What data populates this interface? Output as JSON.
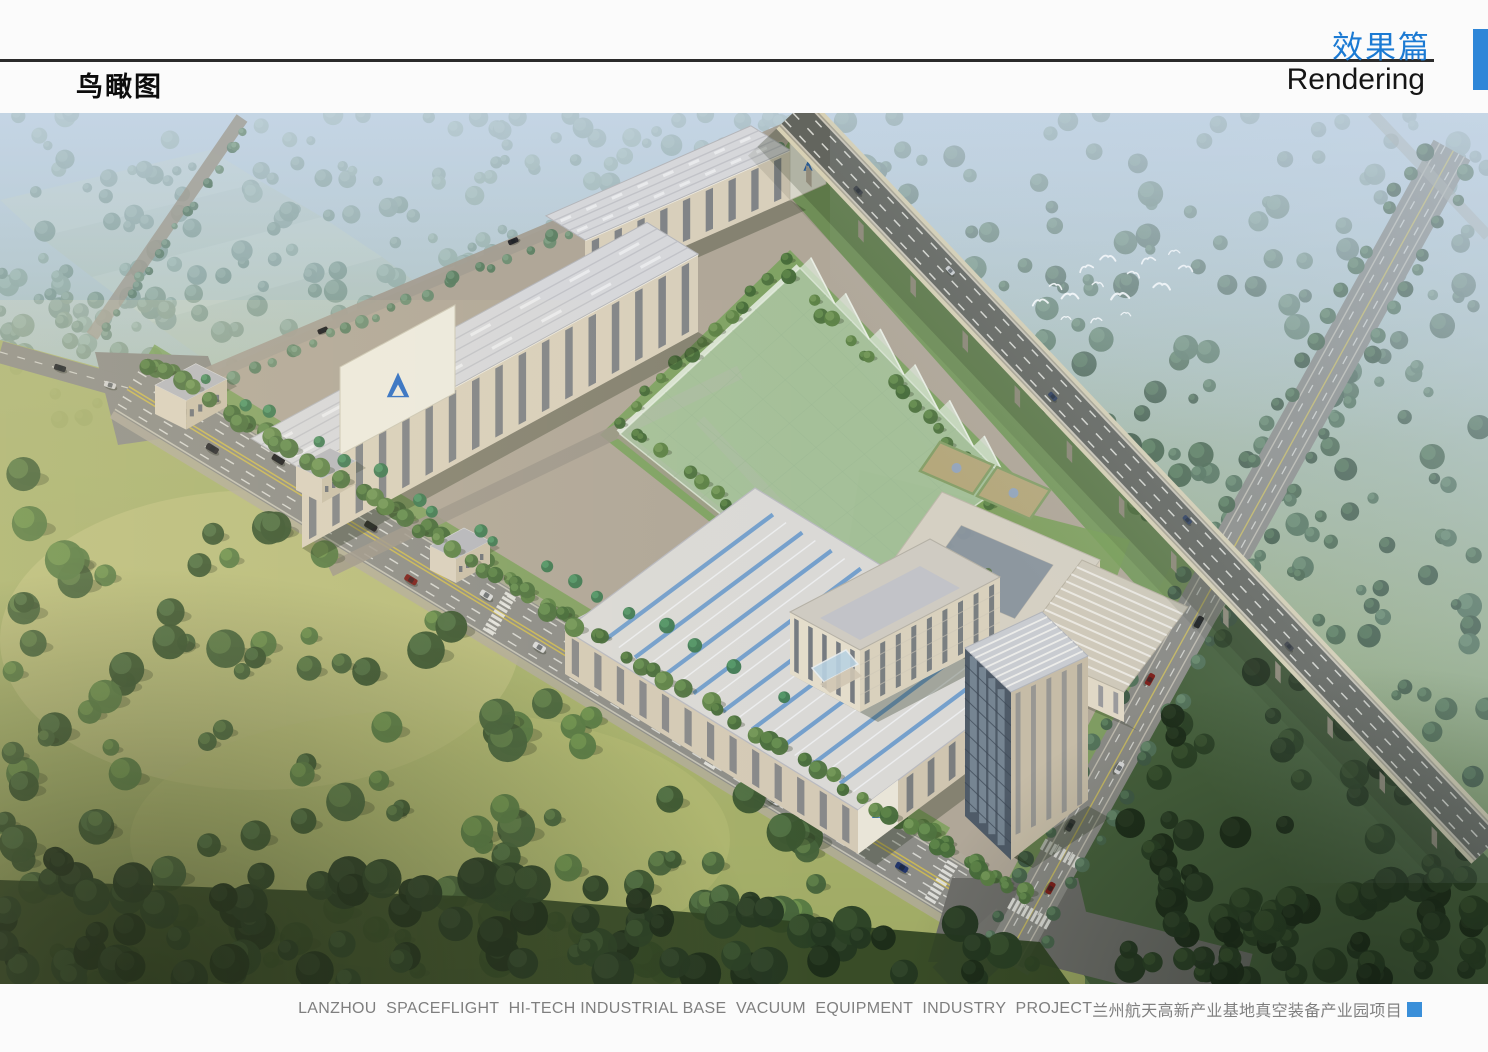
{
  "header": {
    "section_title_zh": "效果篇",
    "section_title_en": "Rendering",
    "page_title": "鸟瞰图"
  },
  "footer": {
    "caption_en": "LANZHOU  SPACEFLIGHT  HI-TECH INDUSTRIAL BASE  VACUUM  EQUIPMENT  INDUSTRY  PROJECT",
    "caption_zh": "兰州航天高新产业基地真空装备产业园项目"
  },
  "accents": {
    "section_title_color": "#1b7ad3",
    "header_block_color": "#2e86d8",
    "footer_block_color": "#3a8fd9",
    "pool_water_color": "#7db0d2",
    "glass_field_color": "#aec7a6",
    "flag_color": "#d5281c"
  },
  "scene": {
    "alt": "Aerial bird's-eye rendering of the Lanzhou spaceflight hi-tech industrial park: long factory workshops with striped roofs, a translucent green glass field, office buildings around a fountain plaza, tree-lined boulevards and an elevated expressway crossing hazy green countryside"
  }
}
